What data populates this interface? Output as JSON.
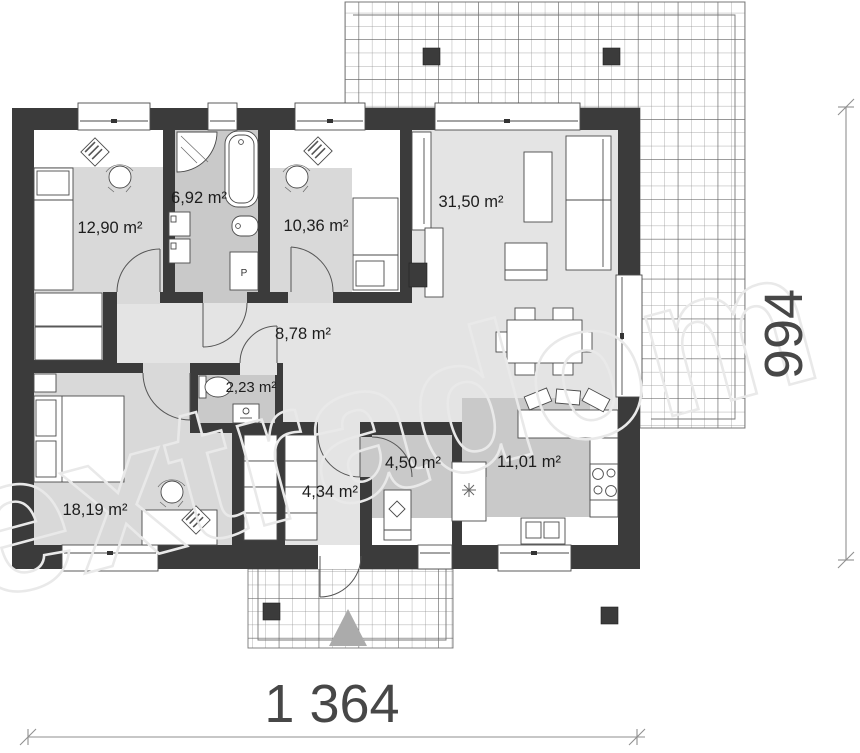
{
  "watermark": {
    "text": "extradom"
  },
  "dimensions": {
    "width_label": "1 364",
    "depth_label": "994"
  },
  "rooms": {
    "bedroom_top_left": {
      "area": "12,90 m²"
    },
    "bathroom": {
      "area": "6,92 m²"
    },
    "bedroom_top_middle": {
      "area": "10,36 m²"
    },
    "living_room": {
      "area": "31,50 m²"
    },
    "hallway": {
      "area": "8,78 m²"
    },
    "wc": {
      "area": "2,23 m²"
    },
    "bedroom_bottom_left": {
      "area": "18,19 m²"
    },
    "entrance_hall": {
      "area": "4,34 m²"
    },
    "utility_room": {
      "area": "4,50 m²"
    },
    "kitchen": {
      "area": "11,01 m²"
    }
  },
  "fixtures": {
    "pantry_label": "P"
  },
  "colors": {
    "wall": "#3b3b3b",
    "floor_light": "#e4e4e4",
    "floor_mid": "#d9d9d9",
    "floor_dark": "#c9c9c9",
    "watermark": "#e9e9e9",
    "dimension_text": "#474747"
  }
}
